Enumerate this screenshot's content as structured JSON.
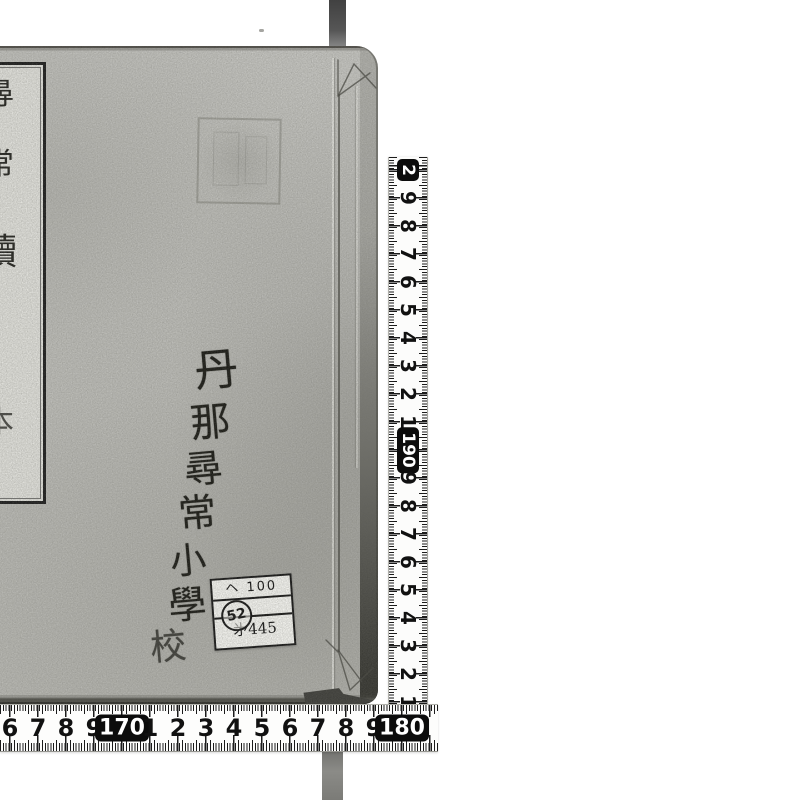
{
  "book": {
    "spine_title": {
      "text": "尋常讀本",
      "chars": [
        "尋",
        "常",
        "讀",
        "本"
      ]
    },
    "handwriting": {
      "text": "丹那尋常小學校",
      "chars": [
        "丹",
        "那",
        "尋",
        "常",
        "小",
        "學",
        "校"
      ]
    },
    "label": {
      "class_mark": "ヘ 100",
      "stamp_number": "52",
      "item_number": "㐧445"
    }
  },
  "rulers": {
    "vertical": {
      "unit": "cm",
      "labels": [
        {
          "t": "2",
          "box": true
        },
        {
          "t": "9"
        },
        {
          "t": "8"
        },
        {
          "t": "7"
        },
        {
          "t": "6"
        },
        {
          "t": "5"
        },
        {
          "t": "4"
        },
        {
          "t": "3"
        },
        {
          "t": "2"
        },
        {
          "t": "1"
        },
        {
          "t": "190",
          "box": true
        },
        {
          "t": "9"
        },
        {
          "t": "8"
        },
        {
          "t": "7"
        },
        {
          "t": "6"
        },
        {
          "t": "5"
        },
        {
          "t": "4"
        },
        {
          "t": "3"
        },
        {
          "t": "2"
        },
        {
          "t": "1"
        }
      ]
    },
    "horizontal": {
      "unit": "cm",
      "labels": [
        {
          "t": "6"
        },
        {
          "t": "7"
        },
        {
          "t": "8"
        },
        {
          "t": "9"
        },
        {
          "t": "170",
          "box": true
        },
        {
          "t": "1"
        },
        {
          "t": "2"
        },
        {
          "t": "3"
        },
        {
          "t": "4"
        },
        {
          "t": "5"
        },
        {
          "t": "6"
        },
        {
          "t": "7"
        },
        {
          "t": "8"
        },
        {
          "t": "9"
        },
        {
          "t": "180",
          "box": true
        }
      ]
    }
  },
  "colors": {
    "background": "#ffffff",
    "cover_paper": "#c4c4c0",
    "slip_paper": "#e3e3de",
    "ink": "#181813",
    "ruler_ink": "#141414",
    "ruler_bg": "#fdfdfc",
    "strap": "#5a5a58"
  }
}
